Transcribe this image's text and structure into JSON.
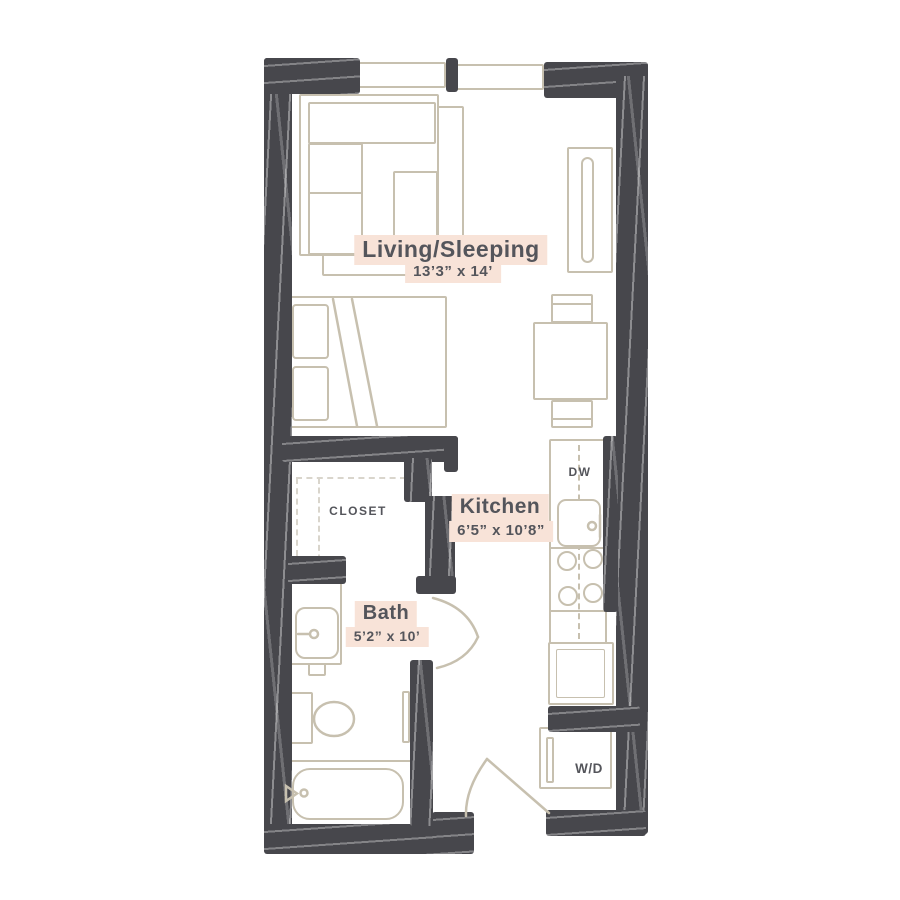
{
  "floor_plan": {
    "rooms": {
      "living": {
        "name": "Living/Sleeping",
        "dimensions": "13’3” x 14’"
      },
      "kitchen": {
        "name": "Kitchen",
        "dimensions": "6’5” x 10’8”"
      },
      "bath": {
        "name": "Bath",
        "dimensions": "5’2” x 10’"
      },
      "closet": {
        "name": "CLOSET"
      }
    },
    "appliances": {
      "dishwasher_label": "DW",
      "washer_dryer_label": "W/D"
    }
  },
  "colors": {
    "wall": "#47474c",
    "furniture_line": "#c7c0af",
    "label_text": "#54555b",
    "label_highlight": "#f8e3d8",
    "closet_dash": "#d9d5cc",
    "background": "#ffffff"
  }
}
